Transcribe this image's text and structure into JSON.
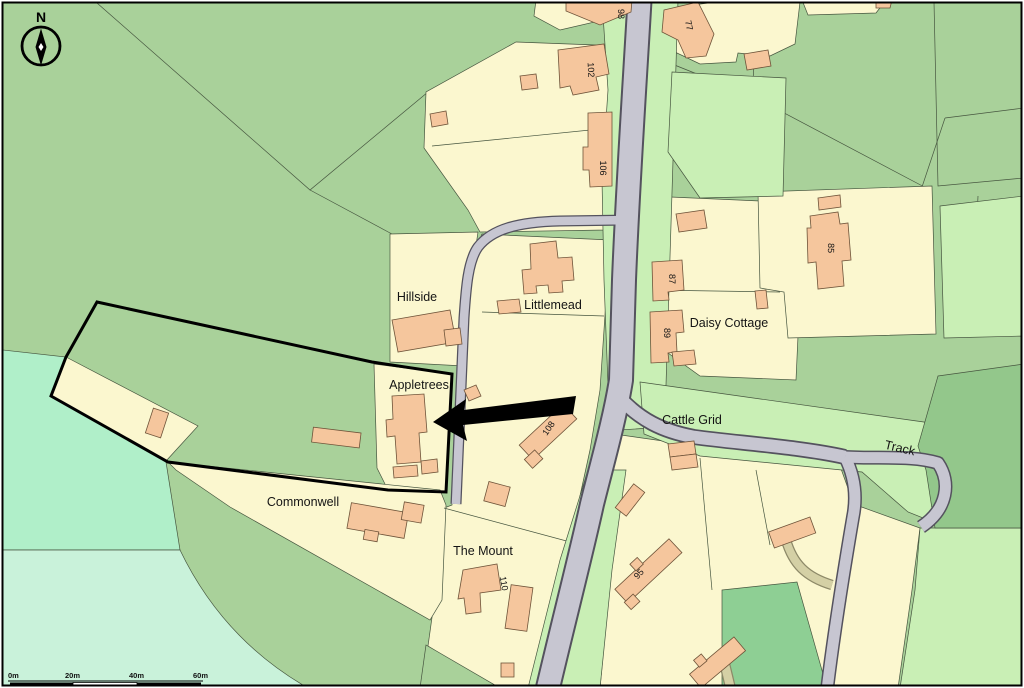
{
  "map": {
    "place_labels": [
      {
        "text": "Hillside"
      },
      {
        "text": "Littlemead"
      },
      {
        "text": "Daisy Cottage"
      },
      {
        "text": "Appletrees"
      },
      {
        "text": "Commonwell"
      },
      {
        "text": "The Mount"
      },
      {
        "text": "Cattle Grid"
      },
      {
        "text": "Track"
      }
    ],
    "house_numbers": [
      {
        "text": "98"
      },
      {
        "text": "77"
      },
      {
        "text": "102"
      },
      {
        "text": "106"
      },
      {
        "text": "85"
      },
      {
        "text": "87"
      },
      {
        "text": "89"
      },
      {
        "text": "108"
      },
      {
        "text": "110"
      },
      {
        "text": "95"
      }
    ],
    "compass": {
      "label": "N"
    },
    "scale_bar": {
      "tick_labels": [
        {
          "text": "0m"
        },
        {
          "text": "20m"
        },
        {
          "text": "40m"
        },
        {
          "text": "60m"
        }
      ]
    },
    "colors": {
      "field_green": "#a9d19a",
      "dark_green": "#93c78b",
      "light_green": "#c9efb5",
      "mint_green": "#b0efc9",
      "pale_mint": "#c9f2da",
      "parcel_yellow": "#fbf7cf",
      "building_fill": "#f5c69d",
      "road_gray": "#c7c6d1",
      "track_khaki": "#d4d0a5",
      "site_boundary": "#000000",
      "pointer_arrow": "#000000"
    }
  }
}
